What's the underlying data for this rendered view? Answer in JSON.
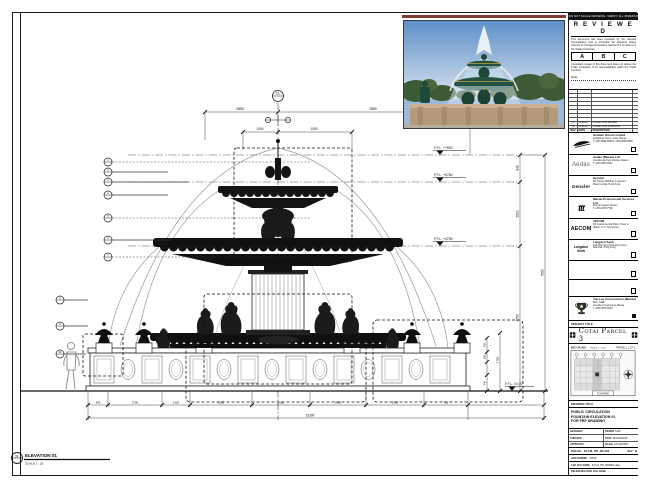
{
  "sheet": {
    "top_bar": "DO NOT SCALE DRAWING. VERIFY ALL DIMENSIONS ON SITE.",
    "stamp": {
      "title": "R E V I E W E D",
      "body1": "This document has been reviewed by the relevant Consultant(s) and is accorded the following status referred to in Project Procedure Section 5.4 for action by the Trade Contractor.",
      "grades": [
        "A",
        "B",
        "C"
      ],
      "body2": "Consultant review of this document does not relieve the Trade Contractor of its responsibilities under the Trade Contract.",
      "date_label": "Date :"
    },
    "revisions": {
      "header": {
        "rev": "REV",
        "date": "DATE",
        "description": "DESCRIPTION"
      },
      "entries": [
        {
          "rev": "A",
          "date": "04/12/15",
          "description": "ISSUED FOR REVIEW"
        },
        {
          "rev": "B",
          "date": "13/01/16",
          "description": "ISSUED FOR APPROVAL"
        }
      ]
    }
  },
  "consultants": [
    {
      "name": "Handan Orient Limited",
      "details1": "Estrada do Istmo, Cotai, Macau",
      "details2": "T +853 8868 6688  F +853 8868 6699"
    },
    {
      "name": "Aedas (Macau) Ltd.",
      "logo_text": "Aedas",
      "details1": "Avenida da Praia Grande, Macau",
      "details2": "T +853 2833 3933"
    },
    {
      "name": "Gensler",
      "logo_text": "Gensler",
      "details1": "4/F Henley Building, 5 Queen's",
      "details2": "Road Central, Hong Kong"
    },
    {
      "name": "Macau Professional Services Ltd.",
      "logo_text": "ttt",
      "details1": "Rua de Xangai, Macau",
      "details2": "T +853 2878 7708"
    },
    {
      "name": "AECOM",
      "logo_text": "AECOM",
      "details1": "8/F Grand Central Plaza, Tower 2,",
      "details2": "Shatin, N.T., Hong Kong"
    },
    {
      "name": "Langdon Seah",
      "logo_text": "Langdon Seah",
      "details1": "19/F Dah Sing Financial Centre,",
      "details2": "Wanchai, Hong Kong"
    }
  ],
  "contractor": {
    "name": "Yau Lee Construction (Macau) Co., Ltd.",
    "details1": "Avenida Comercial de Macau",
    "details2": "T +853 2875 5000"
  },
  "project": {
    "label": "PROJECT TITLE",
    "name": "Cotai Parcel 3"
  },
  "key_plan": {
    "label": "KEY PLAN",
    "scale": "SCALE 1 : 7500",
    "parcel": "PARCEL 1, LOT 3",
    "tag": "FOUNTAIN"
  },
  "drawing_title": {
    "label": "DRAWING TITLE",
    "line1": "PUBLIC CIRCULATION",
    "line2": "FOUNTAIN ELEVATION 01",
    "line3": "FOR FRP DRAWING"
  },
  "info": {
    "designed_label": "DESIGNED",
    "designed": "",
    "drawn_label": "DRAWN",
    "drawn": "CAD",
    "checked_label": "CHECKED",
    "checked": "-",
    "date_label": "DATE",
    "date": "13/JAN/2016",
    "approved_label": "APPROVED",
    "approved": "-",
    "scale_label": "SCALE",
    "scale": "AS SHOWN"
  },
  "refs": {
    "dwg_label": "DWG NO.",
    "dwg": "SYLM_PD_JB-001",
    "rev_label": "REV.",
    "rev": "B",
    "job_label": "JOB NUMBER",
    "job": "31515",
    "cad_label": "CAD FILE NAME",
    "cad": "SYLM_PD_DRW01.dwg",
    "ref_label": "REFERENCE DWG FILE NAME",
    "ref": "-"
  },
  "drawing": {
    "grid_bubble": "CL",
    "elevation": {
      "bubble": "01",
      "title": "ELEVATION 01",
      "scale": "SCALE 1 : 25"
    },
    "levels": {
      "top": "F.F.L. +7600",
      "second": "F.F.L. +6760",
      "third": "F.F.L. +4750",
      "ground": "F.F.L. ±0.00"
    },
    "dims": {
      "top_left": "2850",
      "top_right": "2850",
      "top_inner_left": "1050",
      "top_inner_right": "1050",
      "right_1": "840",
      "right_2": "2010",
      "right_3": "4750",
      "right_overall": "7600",
      "right_urn": "1750",
      "right_small_1": "450",
      "right_small_2": "350",
      "right_small_3": "450",
      "bottom_1": "450",
      "bottom_2": "2700",
      "bottom_3": "1400",
      "bottom_4": "3100",
      "bottom_5": "3100",
      "bottom_6": "1400",
      "bottom_7": "2700",
      "bottom_8": "450",
      "bottom_overall": "15300"
    },
    "callouts": [
      "1",
      "2",
      "3",
      "4",
      "5",
      "6",
      "7",
      "8",
      "9",
      "10"
    ]
  }
}
